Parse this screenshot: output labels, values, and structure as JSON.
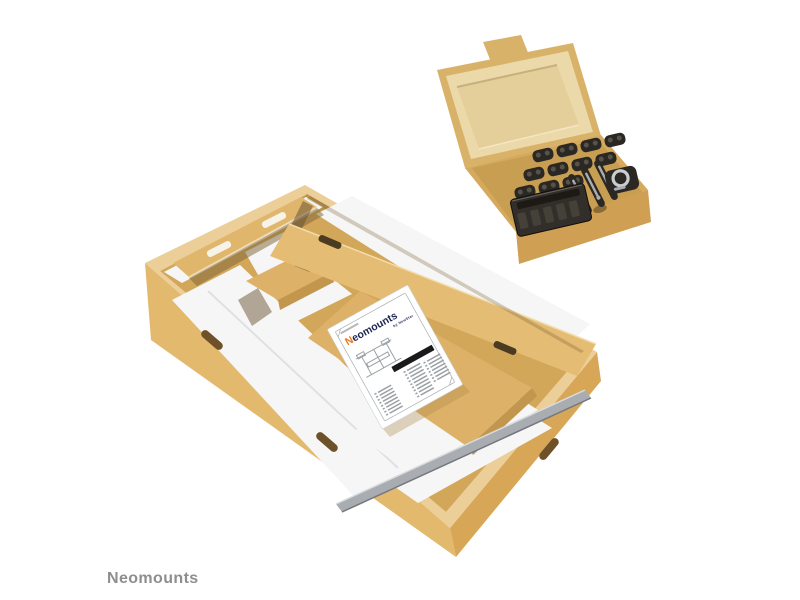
{
  "page": {
    "background": "#ffffff"
  },
  "brand": {
    "watermark": "Neomounts"
  },
  "leaflet": {
    "logo_first": "N",
    "logo_rest": "eomounts",
    "tagline": "by NewStar"
  },
  "palette": {
    "bg": "#ffffff",
    "text_gray": "#8e8e8e",
    "wall_left": "#e3b96d",
    "wall_right": "#d7a757",
    "rim": "#ecce98",
    "floor": "#d2a75a",
    "flap": "#e0b66c",
    "plank": "#e4bc73",
    "gold_box": "#ddb268",
    "gold_box_side": "#c2974d",
    "white_foam": "#f6f6f7",
    "foam_shade": "#d9dcdf",
    "foam_dark": "#74787e",
    "metal": "#a9adb2",
    "metal_light": "#c9ccd0",
    "shadow_brown": "#7c6134",
    "gap_dark": "#6b5433",
    "slot_cut": "#4a3b21",
    "slot_white": "#f7f3e8",
    "handle_slot": "#6e5128",
    "lid_outer": "#d9b269",
    "lid_face": "#ecd9a9",
    "lid_recess": "#e4cf9b",
    "body_top": "#d6aa5c",
    "body_interior": "#c79e52",
    "body_front": "#cfa053",
    "notch_brown": "#8a6a36",
    "dark_slot": "#2b2723",
    "screw": "#57524a",
    "tray": "#322e29",
    "tray_slat": "#454038",
    "tray_shelf": "#1d1a16",
    "leaflet_border": "#a9adb1",
    "leaflet_ink": "#9aa0a4",
    "leaflet_faint": "#b8b8b8",
    "leaflet_bar": "#1a1a1a",
    "logo_navy": "#1d2753",
    "logo_orange": "#f07818"
  }
}
